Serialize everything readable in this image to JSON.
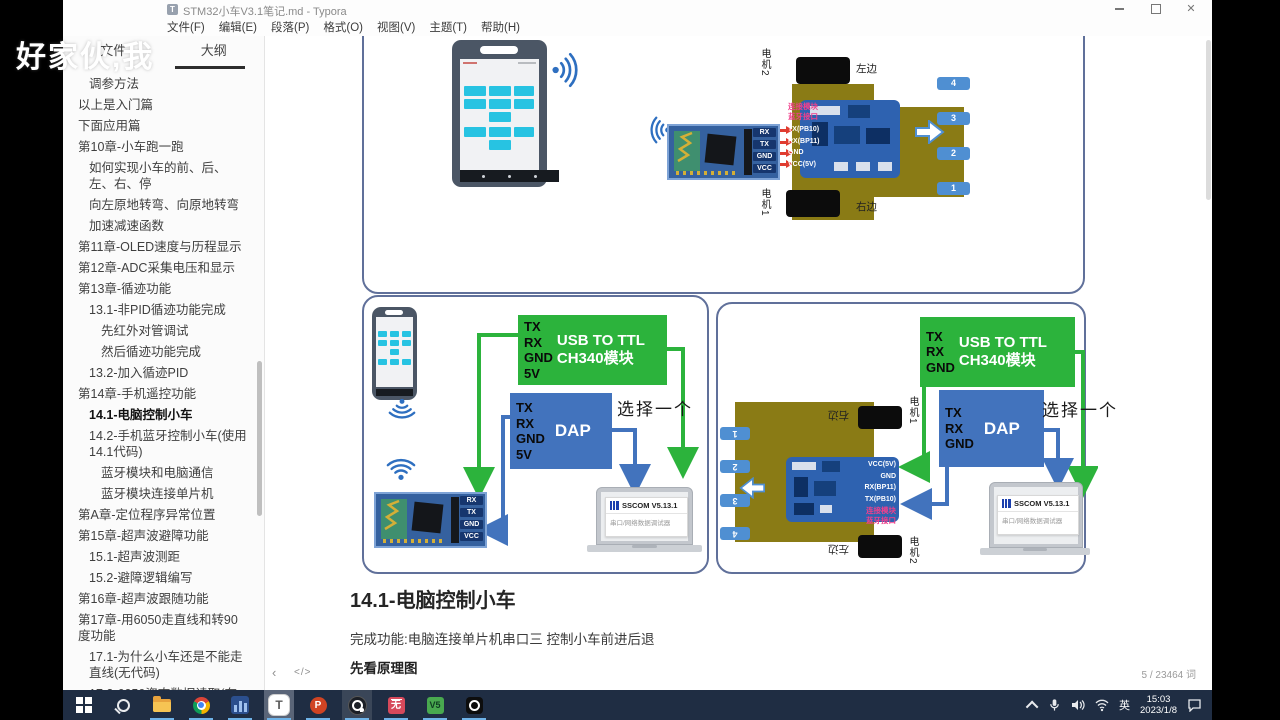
{
  "window": {
    "title": "STM32小车V3.1笔记.md - Typora",
    "app_icon_letter": "T",
    "menu": [
      "文件(F)",
      "编辑(E)",
      "段落(P)",
      "格式(O)",
      "视图(V)",
      "主题(T)",
      "帮助(H)"
    ]
  },
  "watermark": "好家伙,我",
  "sidebar": {
    "tabs": [
      {
        "label": "文件"
      },
      {
        "label": "大纲"
      }
    ],
    "items": [
      {
        "label": "调参方法",
        "indent": 2
      },
      {
        "label": "以上是入门篇",
        "indent": 1
      },
      {
        "label": "下面应用篇",
        "indent": 1
      },
      {
        "label": "第10章-小车跑一跑",
        "indent": 1
      },
      {
        "label": "如何实现小车的前、后、左、右、停",
        "indent": 2
      },
      {
        "label": "向左原地转弯、向原地转弯",
        "indent": 2
      },
      {
        "label": "加速减速函数",
        "indent": 2
      },
      {
        "label": "第11章-OLED速度与历程显示",
        "indent": 1
      },
      {
        "label": "第12章-ADC采集电压和显示",
        "indent": 1
      },
      {
        "label": "第13章-循迹功能",
        "indent": 1
      },
      {
        "label": "13.1-非PID循迹功能完成",
        "indent": 2
      },
      {
        "label": "先红外对管调试",
        "indent": 3
      },
      {
        "label": "然后循迹功能完成",
        "indent": 3
      },
      {
        "label": "13.2-加入循迹PID",
        "indent": 2
      },
      {
        "label": "第14章-手机遥控功能",
        "indent": 1
      },
      {
        "label": "14.1-电脑控制小车",
        "indent": 2,
        "active": true
      },
      {
        "label": "14.2-手机蓝牙控制小车(使用14.1代码)",
        "indent": 2
      },
      {
        "label": "蓝牙模块和电脑通信",
        "indent": 3
      },
      {
        "label": "蓝牙模块连接单片机",
        "indent": 3
      },
      {
        "label": "第A章-定位程序异常位置",
        "indent": 1
      },
      {
        "label": "第15章-超声波避障功能",
        "indent": 1
      },
      {
        "label": "15.1-超声波测距",
        "indent": 2
      },
      {
        "label": "15.2-避障逻辑编写",
        "indent": 2
      },
      {
        "label": "第16章-超声波跟随功能",
        "indent": 1
      },
      {
        "label": "第17章-用6050走直线和转90度功能",
        "indent": 1
      },
      {
        "label": "17.1-为什么小车还是不能走直线(无代码)",
        "indent": 2
      },
      {
        "label": "17.2-6050姿态数据读取(有代码)",
        "indent": 2
      }
    ]
  },
  "document": {
    "heading": "14.1-电脑控制小车",
    "paragraph": "完成功能:电脑连接单片机串口三 控制小车前进后退",
    "bold_line": "先看原理图"
  },
  "statusbar": {
    "back_glyph": "‹",
    "source_glyph": "</>",
    "word_count": "5 / 23464 词"
  },
  "diagrams": {
    "top": {
      "motor_top": {
        "name": "电机2",
        "side": "左边"
      },
      "motor_bottom": {
        "name": "电机1",
        "side": "右边"
      },
      "module_pins": [
        "RX",
        "TX",
        "GND",
        "VCC"
      ],
      "board_pins": [
        "TX(PB10)",
        "RX(BP11)",
        "GND",
        "VCC(5V)"
      ],
      "board_note": [
        "连接模块",
        "蓝牙接口"
      ],
      "wheels": [
        "4",
        "3",
        "2",
        "1"
      ]
    },
    "left_box": {
      "usb_module": {
        "pins": [
          "TX",
          "RX",
          "GND",
          "5V"
        ],
        "title_line1": "USB TO TTL",
        "title_line2": "CH340模块"
      },
      "dap_module": {
        "pins": [
          "TX",
          "RX",
          "GND",
          "5V"
        ],
        "label": "DAP"
      },
      "choose_one": "选择一个",
      "module_pins": [
        "RX",
        "TX",
        "GND",
        "VCC"
      ],
      "laptop": {
        "app": "SSCOM V5.13.1",
        "subtitle": "串口/网络数据调试器"
      }
    },
    "right_box": {
      "usb_module": {
        "pins": [
          "TX",
          "RX",
          "GND"
        ],
        "title_line1": "USB TO TTL",
        "title_line2": "CH340模块"
      },
      "dap_module": {
        "pins": [
          "TX",
          "RX",
          "GND"
        ],
        "label": "DAP"
      },
      "choose_one": "选择一个",
      "wheels": [
        "1",
        "2",
        "3",
        "4"
      ],
      "motor_top": {
        "name": "电机1",
        "side": "右边"
      },
      "motor_bottom": {
        "name": "电机2",
        "side": "左边"
      },
      "board_pins": [
        "VCC(5V)",
        "GND",
        "RX(BP11)",
        "TX(PB10)"
      ],
      "board_note": [
        "连接模块",
        "蓝牙接口"
      ],
      "laptop": {
        "app": "SSCOM V5.13.1",
        "subtitle": "串口/网络数据调试器"
      }
    }
  },
  "taskbar": {
    "typora_glyph": "T",
    "ppt_glyph": "P",
    "red_glyph": "无",
    "keil_glyph": "V5"
  },
  "tray": {
    "lang": "英",
    "time": "15:03",
    "date": "2023/1/8"
  }
}
